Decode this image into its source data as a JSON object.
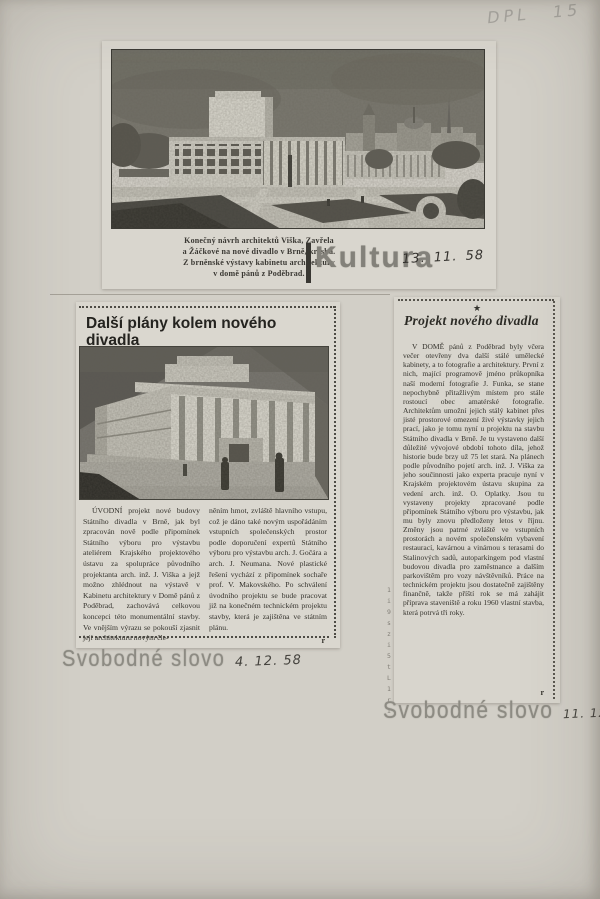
{
  "page": {
    "pencil_note": "DPL 15"
  },
  "top_clipping": {
    "image_alt": "Halftone drawing of the new theatre building in Brno with colonnade, park paths and city spires",
    "caption_lines": [
      "Konečný návrh architektů Viška, Zavřela",
      "a Žáčkové na nové divadlo v Brně, kresba.",
      "Z brněnské výstavy kabinetu architektury",
      "v domě pánů z Poděbrad."
    ]
  },
  "kultura": {
    "stamp": "Kultura",
    "date": "13. 11. 58"
  },
  "left_clipping": {
    "headline": "Další plány kolem nového divadla",
    "image_alt": "Perspective drawing of the State Theatre with tall columns and figures in the foreground",
    "col1": "ÚVODNÍ projekt nové budovy Státního divadla v Brně, jak byl zpracován nově podle připomínek Státního výboru pro výstavbu ateliérem Krajského projektového ústavu za spolupráce původního projektanta arch. inž. J. Viška a jejž možno zhlédnout na výstavě v Kabinetu architektury v Domě pánů z Poděbrad, zachovává celkovou koncepci této monumentální stavby. Ve vnějším výrazu se pokouší zjasnit její architekturu novým čle-",
    "col2": "něním hmot, zvláště hlavního vstupu, což je dáno také novým uspořádáním vstupních společenských prostor podle doporučení expertů Státního výboru pro výstavbu arch. J. Gočára a arch. J. Neumana. Nové plastické řešení vychází z připomínek sochaře prof. V. Makovského. Po schválení úvodního projektu se bude pracovat již na konečném technickém projektu stavby, která je zajištěna ve státním plánu.",
    "signature": "r"
  },
  "right_clipping": {
    "star": "★",
    "headline": "Projekt nového divadla",
    "body": "V DOMĚ pánů z Poděbrad byly včera večer otevřeny dva další stálé umělecké kabinety, a to fotografie a architektury. První z nich, mající programově jméno průkopníka naší moderní fotografie J. Funka, se stane nepochybně přitažlivým místem pro stále rostoucí obec amatérské fotografie. Architektům umožní jejich stálý kabinet přes jisté prostorové omezení živé výstavky jejich prací, jako je tomu nyní u projektu na stavbu Státního divadla v Brně. Je tu vystaveno další důležité vývojové období tohoto díla, jehož historie bude brzy už 75 let stará. Na plánech podle původního pojetí arch. inž. J. Viška za jeho součinnosti jako experta pracuje nyní v Krajském projektovém ústavu skupina za vedení arch. inž. O. Oplatky. Jsou tu vystaveny projekty zpracované podle připomínek Státního výboru pro výstavbu, jak mu byly znovu předloženy letos v říjnu. Změny jsou patrné zvláště ve vstupních prostorách a novém společenském vybavení restaurací, kavárnou a vinárnou s terasami do Stalinových sadů, autoparkingem pod vlastní budovou divadla pro zaměstnance a dalším parkovištěm pro vozy návštěvníků. Práce na technickém projektu jsou dostatečně zajištěny finančně, takže příští rok se má zahájit příprava staveniště a roku 1960 vlastní stavba, která potrvá tři roky.",
    "signature": "r",
    "edge_marks": "1 i 9 s z i 5 t L 1 r i"
  },
  "stamps": [
    {
      "name": "Svobodné slovo",
      "date": "4. 12. 58"
    },
    {
      "name": "Svobodné slovo",
      "date": "11. 12. 58"
    }
  ],
  "colors": {
    "paper": "#d2cfc7",
    "clipping": "#dad7cf",
    "ink": "#34322c",
    "stamp_gray": "#8d8b83",
    "pencil_gray": "#a9a7a1"
  }
}
